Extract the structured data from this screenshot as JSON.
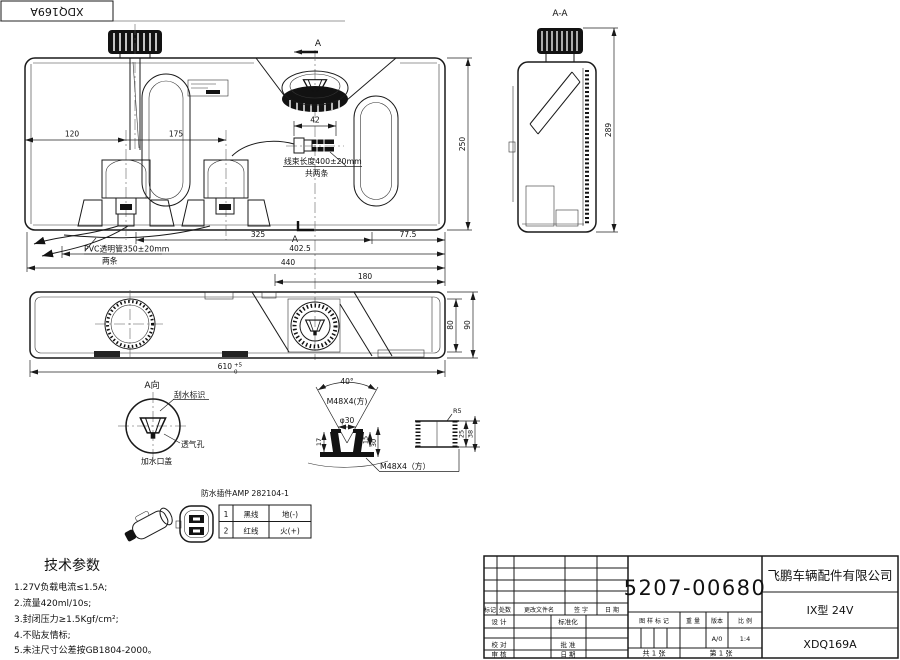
{
  "corner": {
    "label": "XDQ169A"
  },
  "front_view": {
    "dim_120": "120",
    "dim_175": "175",
    "dim_42": "42",
    "dim_250": "250",
    "dim_325": "325",
    "dim_402_5": "402.5",
    "dim_440": "440",
    "dim_77_5": "77.5",
    "dim_180": "180",
    "section_mark_top": "A",
    "section_mark_bottom": "A",
    "harness_note_1": "线束长度400±20mm",
    "harness_note_2": "共两条",
    "pvc_note_1": "PVC透明管350±20mm",
    "pvc_note_2": "两条"
  },
  "section_view": {
    "title": "A-A",
    "dim_289": "289"
  },
  "plan_view": {
    "dim_80": "80",
    "dim_90": "90",
    "dim_610": "610",
    "tol_up": "+5",
    "tol_down": "0",
    "view_label": "A向"
  },
  "detail_a": {
    "wiper_label": "刮水标识",
    "vent_label": "透气孔",
    "filler_label": "加水口盖"
  },
  "thread_detail": {
    "angle": "40°",
    "thread": "M48X4(方)",
    "diameter": "φ30",
    "dim_17": "17",
    "dim_15": "15",
    "dim_30": "30",
    "thread_bottom": "M48X4（方）"
  },
  "cap_detail": {
    "radius": "R5",
    "dim_25": "25",
    "dim_38": "38"
  },
  "connector": {
    "title": "防水插件AMP 282104-1",
    "rows": [
      [
        "1",
        "黑线",
        "地(-)"
      ],
      [
        "2",
        "红线",
        "火(+)"
      ]
    ]
  },
  "tech_params": {
    "title": "技术参数",
    "items": [
      "1.27V负载电流≤1.5A;",
      "2.流量420ml/10s;",
      "3.封闭压力≥1.5Kgf/cm²;",
      "4.不贴友情标;",
      "5.未注尺寸公差按GB1804-2000。"
    ]
  },
  "title_block": {
    "part_number": "5207-00680",
    "company": "飞鹏车辆配件有限公司",
    "model": "IX型 24V",
    "drawing_number": "XDQ169A",
    "rev_cols": [
      "标记",
      "处数",
      "更改文件名",
      "签 字",
      "日 期"
    ],
    "sig": {
      "design": "设 计",
      "standard": "标准化",
      "check": "校 对",
      "approve": "批 准",
      "review": "审 核",
      "date": "日 期"
    },
    "mark_label": "图 样 标 记",
    "weight_label": "重 量",
    "version_label": "版本",
    "scale_label": "比 例",
    "version": "A/0",
    "scale": "1:4",
    "sheet_total": "共 1 张",
    "sheet_number": "第 1 张"
  }
}
